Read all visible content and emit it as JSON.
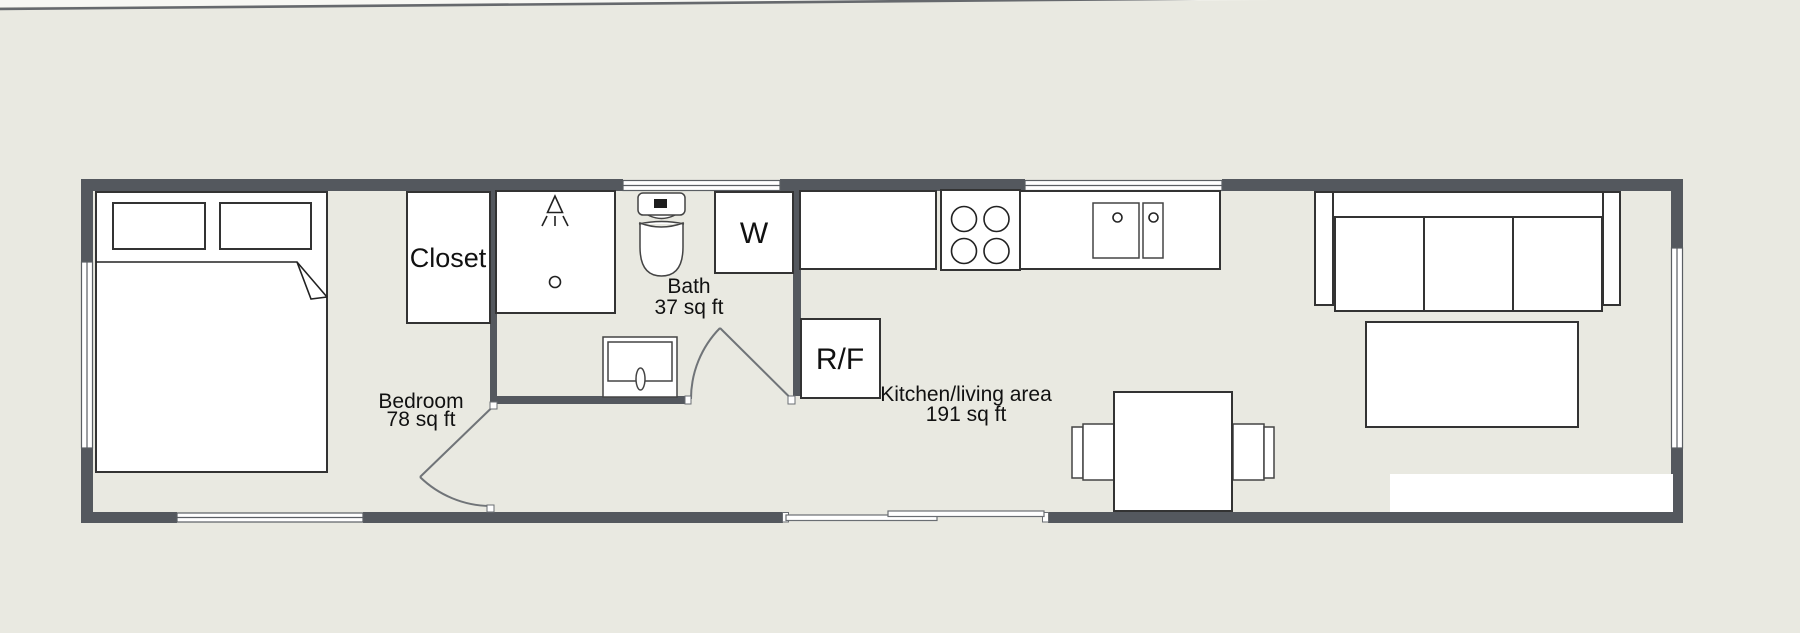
{
  "colors": {
    "background": "#e9e9e1",
    "wall": "#54585e",
    "furniture_fill": "#ffffff",
    "furniture_outline": "#333333",
    "label_text": "#111111"
  },
  "rooms": {
    "bedroom": {
      "name": "Bedroom",
      "area": "78 sq ft"
    },
    "bath": {
      "name": "Bath",
      "area": "37 sq ft"
    },
    "kitchen_living": {
      "name": "Kitchen/living area",
      "area": "191 sq ft"
    }
  },
  "fixtures": {
    "closet": {
      "label": "Closet"
    },
    "washer": {
      "label": "W"
    },
    "refrigerator_freezer": {
      "label": "R/F"
    }
  }
}
